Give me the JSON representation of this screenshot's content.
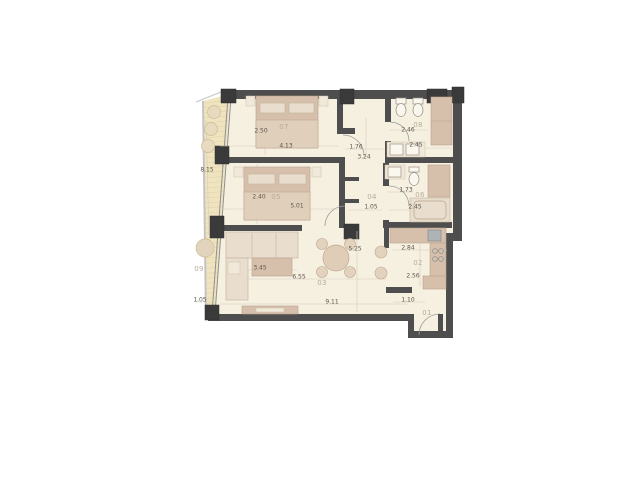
{
  "plan": {
    "type": "apartment-floor-plan",
    "rooms": [
      {
        "id": "07",
        "dims": [
          "2.50",
          "4.13"
        ]
      },
      {
        "id": "08",
        "dims": [
          "2.46",
          "2.45"
        ]
      },
      {
        "id": "04",
        "dims": [
          "1.76",
          "3.24",
          "1.05"
        ]
      },
      {
        "id": "05",
        "dims": [
          "2.40",
          "5.01"
        ]
      },
      {
        "id": "06",
        "dims": [
          "1.73",
          "2.45"
        ]
      },
      {
        "id": "03",
        "dims": [
          "3.45",
          "6.55",
          "5.25",
          "9.11"
        ]
      },
      {
        "id": "02",
        "dims": [
          "2.84",
          "2.56",
          "1.10"
        ]
      },
      {
        "id": "01",
        "dims": []
      },
      {
        "id": "09",
        "dims": [
          "8.15",
          "1.05"
        ]
      }
    ]
  },
  "colors": {
    "floor": "#F6F0E1",
    "wall": "#4E4E4E",
    "column": "#3A3A3A",
    "furn": "#D6C0AC",
    "deck": "#EFE4BF",
    "deck-stripe": "#DDCFA2",
    "dim-text": "#5D564B",
    "room-label": "#B9AC9A"
  }
}
